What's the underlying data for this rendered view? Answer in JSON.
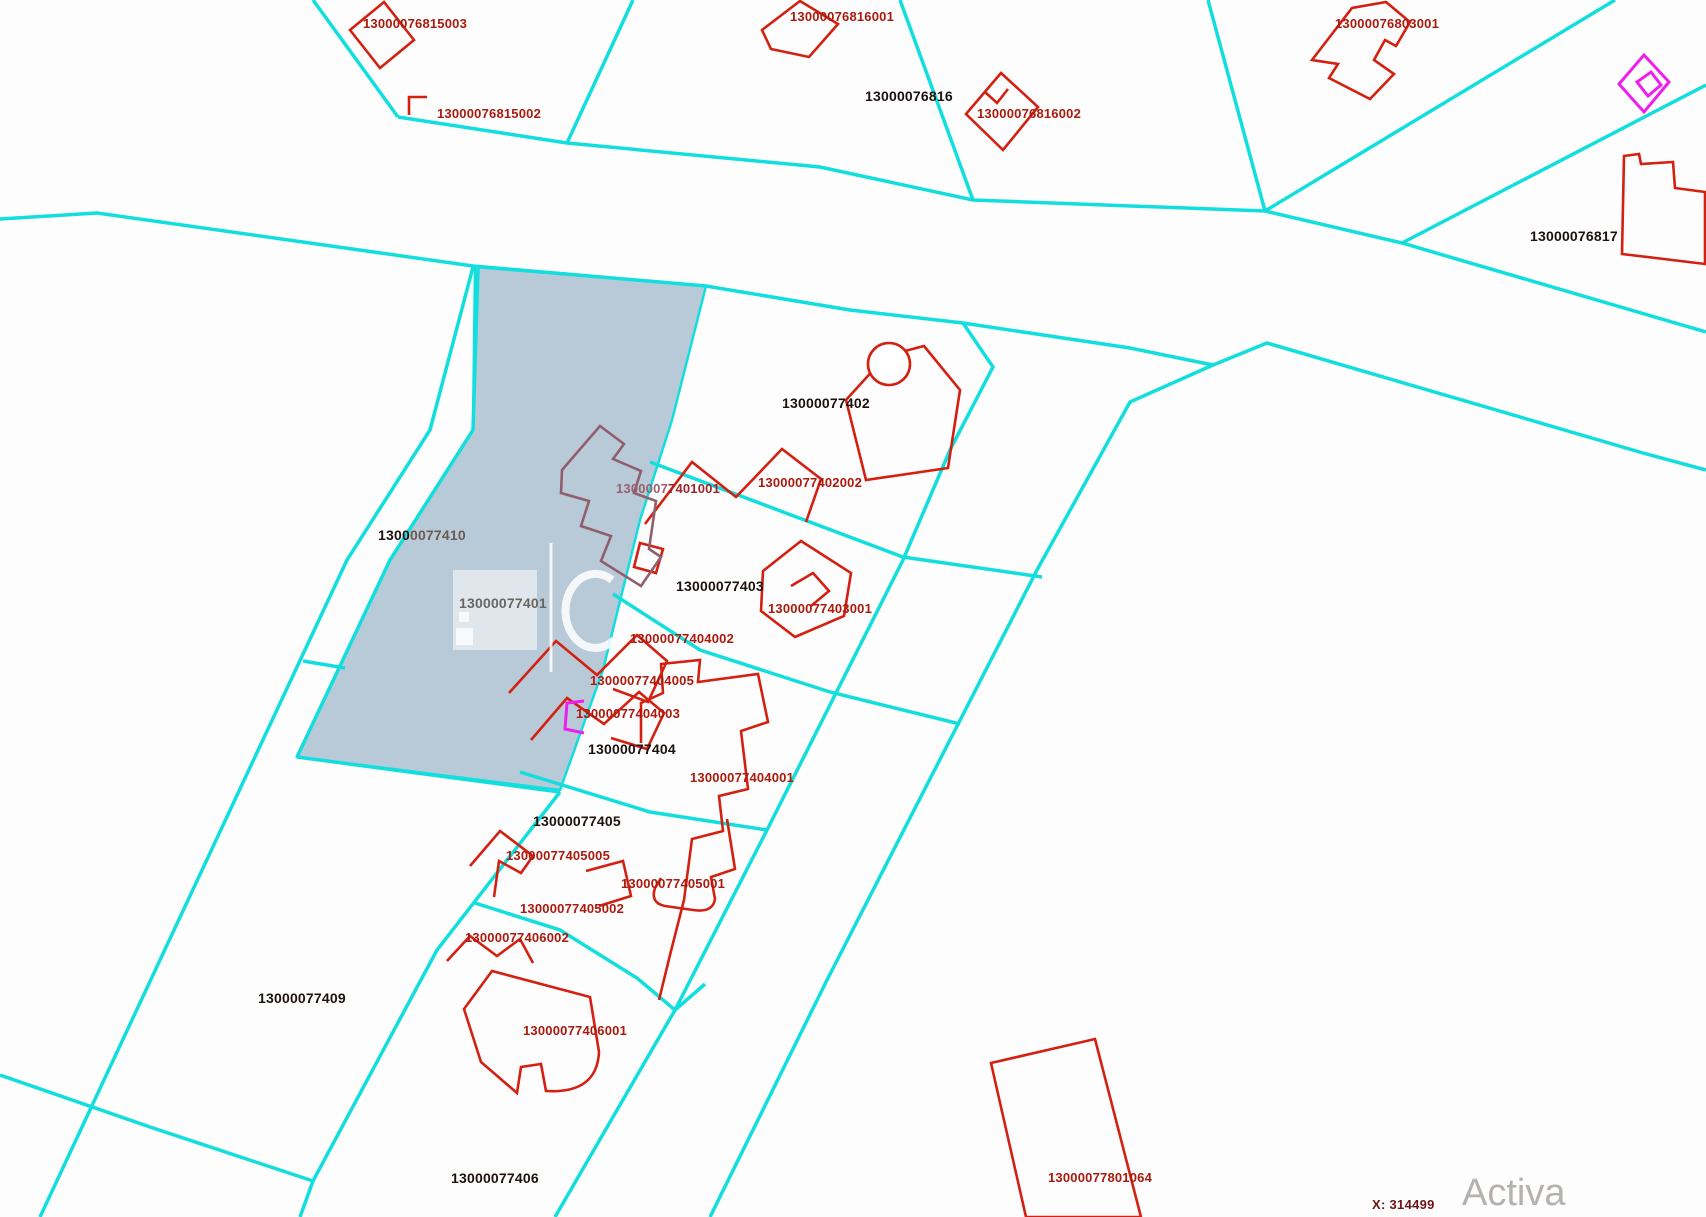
{
  "app": {
    "view": "cadastral-parcel-map"
  },
  "colors": {
    "boundary_cyan": "#12dede",
    "building_red": "#d42010",
    "label_red": "#ab1a0e",
    "label_black": "#1d1210",
    "magenta": "#ee1fee",
    "selected_parcel_fill": "#b8cad7",
    "selected_building_maroon": "#8f5f6e",
    "coordinate_text": "#6b1418",
    "watermark_gray": "#b5b1af"
  },
  "map": {
    "selected_parcel_id": "13000077401",
    "labels": [
      {
        "id": "76815003",
        "text": "13000076815003",
        "type": "red",
        "x": 363,
        "y": 16
      },
      {
        "id": "76815002",
        "text": "13000076815002",
        "type": "red",
        "x": 437,
        "y": 106
      },
      {
        "id": "76816001",
        "text": "13000076816001",
        "type": "red",
        "x": 790,
        "y": 9
      },
      {
        "id": "76816",
        "text": "13000076816",
        "type": "bold",
        "x": 865,
        "y": 88
      },
      {
        "id": "76816002",
        "text": "13000076816002",
        "type": "red",
        "x": 977,
        "y": 106
      },
      {
        "id": "76803001",
        "text": "13000076803001",
        "type": "red",
        "x": 1335,
        "y": 16
      },
      {
        "id": "76817",
        "text": "13000076817",
        "type": "bold",
        "x": 1530,
        "y": 228
      },
      {
        "id": "77402",
        "text": "13000077402",
        "type": "bold",
        "x": 782,
        "y": 395
      },
      {
        "id": "77402002",
        "text": "13000077402002",
        "type": "red",
        "x": 758,
        "y": 475
      },
      {
        "id": "77401001",
        "parts": [
          "1300007",
          "7401001"
        ],
        "type": "maroon",
        "x": 616,
        "y": 481
      },
      {
        "id": "77410",
        "parts": [
          "1300",
          "0077410"
        ],
        "type": "boldmix",
        "x": 378,
        "y": 527
      },
      {
        "id": "77401",
        "text": "13000077401",
        "type": "gray",
        "x": 459,
        "y": 595
      },
      {
        "id": "77403",
        "text": "13000077403",
        "type": "bold",
        "x": 676,
        "y": 578
      },
      {
        "id": "77403001",
        "text": "13000077403001",
        "type": "red",
        "x": 768,
        "y": 601
      },
      {
        "id": "77404002",
        "text": "13000077404002",
        "type": "red",
        "x": 630,
        "y": 631
      },
      {
        "id": "77404005",
        "text": "13000077404005",
        "type": "red",
        "x": 590,
        "y": 673
      },
      {
        "id": "77404003",
        "text": "13000077404003",
        "type": "red",
        "x": 576,
        "y": 706
      },
      {
        "id": "77404",
        "text": "13000077404",
        "type": "bold",
        "x": 588,
        "y": 741
      },
      {
        "id": "77404001",
        "text": "13000077404001",
        "type": "red",
        "x": 690,
        "y": 770
      },
      {
        "id": "77405",
        "text": "13000077405",
        "type": "bold",
        "x": 533,
        "y": 813
      },
      {
        "id": "77405005",
        "text": "13000077405005",
        "type": "red",
        "x": 506,
        "y": 848
      },
      {
        "id": "77405001",
        "text": "13000077405001",
        "type": "red",
        "x": 621,
        "y": 876
      },
      {
        "id": "77405002",
        "text": "13000077405002",
        "type": "red",
        "x": 520,
        "y": 901
      },
      {
        "id": "77406002",
        "text": "13000077406002",
        "type": "red",
        "x": 465,
        "y": 930
      },
      {
        "id": "77409",
        "text": "13000077409",
        "type": "bold",
        "x": 258,
        "y": 990
      },
      {
        "id": "77406001",
        "text": "13000077406001",
        "type": "red",
        "x": 523,
        "y": 1023
      },
      {
        "id": "77406",
        "text": "13000077406",
        "type": "bold",
        "x": 451,
        "y": 1170
      },
      {
        "id": "77801064",
        "text": "13000077801064",
        "type": "red",
        "x": 1048,
        "y": 1170
      }
    ]
  },
  "status": {
    "coordinate_x": "X: 314499"
  },
  "watermark": {
    "text": "Activa"
  }
}
